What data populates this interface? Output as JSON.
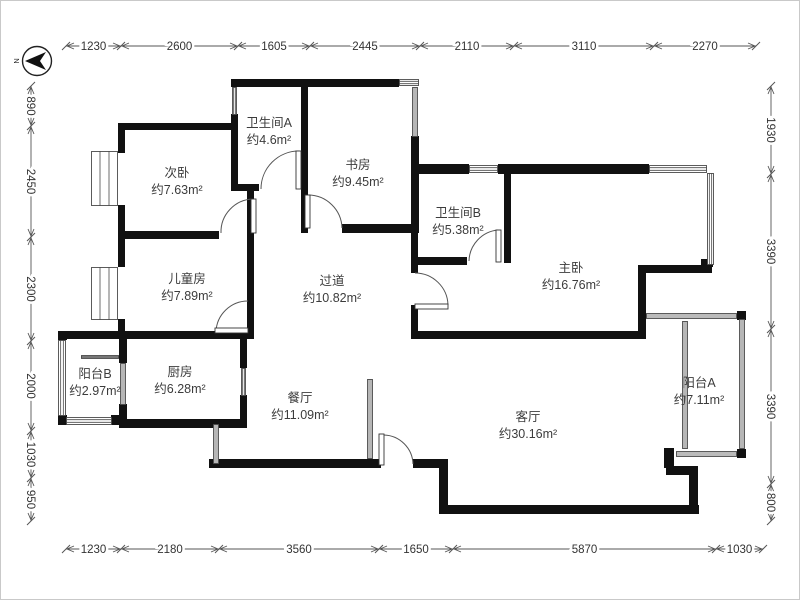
{
  "compass": {
    "label": "N"
  },
  "rooms": [
    {
      "name": "次卧",
      "area": "约7.63m²"
    },
    {
      "name": "卫生间A",
      "area": "约4.6m²"
    },
    {
      "name": "书房",
      "area": "约9.45m²"
    },
    {
      "name": "卫生间B",
      "area": "约5.38m²"
    },
    {
      "name": "主卧",
      "area": "约16.76m²"
    },
    {
      "name": "儿童房",
      "area": "约7.89m²"
    },
    {
      "name": "过道",
      "area": "约10.82m²"
    },
    {
      "name": "阳台B",
      "area": "约2.97m²"
    },
    {
      "name": "厨房",
      "area": "约6.28m²"
    },
    {
      "name": "餐厅",
      "area": "约11.09m²"
    },
    {
      "name": "客厅",
      "area": "约30.16m²"
    },
    {
      "name": "阳台A",
      "area": "约7.11m²"
    }
  ],
  "dimensions": {
    "top": [
      "1230",
      "2600",
      "1605",
      "2445",
      "2110",
      "3110",
      "2270"
    ],
    "bottom": [
      "1230",
      "2180",
      "3560",
      "1650",
      "5870",
      "1030"
    ],
    "left": [
      "890",
      "2450",
      "2300",
      "2000",
      "1030",
      "950"
    ],
    "right": [
      "1930",
      "3390",
      "3390",
      "800"
    ]
  },
  "colors": {
    "wall": "#111111",
    "thin": "#4a4a4a",
    "door": "#555555",
    "room_text": "#3c3c3c",
    "dim_text": "#333333",
    "dim_line": "#555555",
    "background": "#ffffff"
  }
}
